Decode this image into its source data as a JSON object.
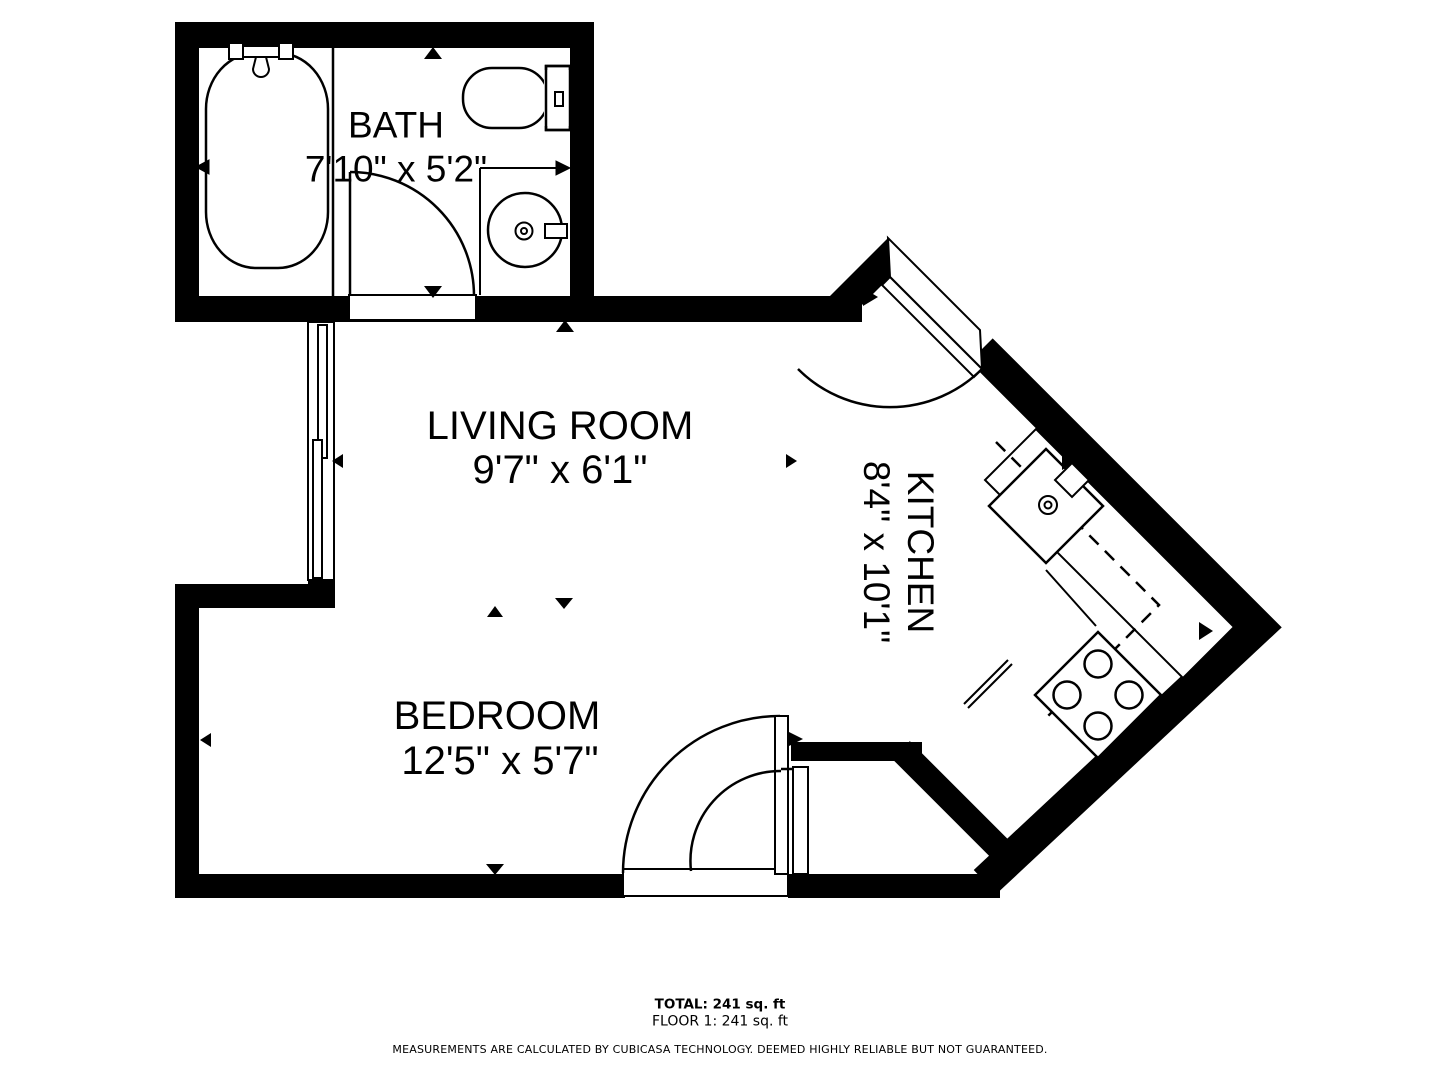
{
  "plan": {
    "type": "floorplan",
    "colors": {
      "wall": "#000000",
      "background": "#ffffff",
      "line": "#000000"
    },
    "rooms": {
      "bath": {
        "name": "BATH",
        "dims": "7'10\" x 5'2\""
      },
      "living": {
        "name": "LIVING ROOM",
        "dims": "9'7\" x 6'1\""
      },
      "kitchen": {
        "name": "KITCHEN",
        "dims": "8'4\" x 10'1\""
      },
      "bedroom": {
        "name": "BEDROOM",
        "dims": "12'5\" x 5'7\""
      }
    },
    "fixtures": [
      "bathtub-icon",
      "toilet-icon",
      "bath-sink-icon",
      "kitchen-sink-icon",
      "stove-icon"
    ],
    "footer": {
      "total": "TOTAL: 241 sq. ft",
      "floor": "FLOOR 1: 241 sq. ft",
      "disclaimer": "MEASUREMENTS ARE CALCULATED BY CUBICASA TECHNOLOGY. DEEMED HIGHLY RELIABLE BUT NOT GUARANTEED."
    }
  }
}
